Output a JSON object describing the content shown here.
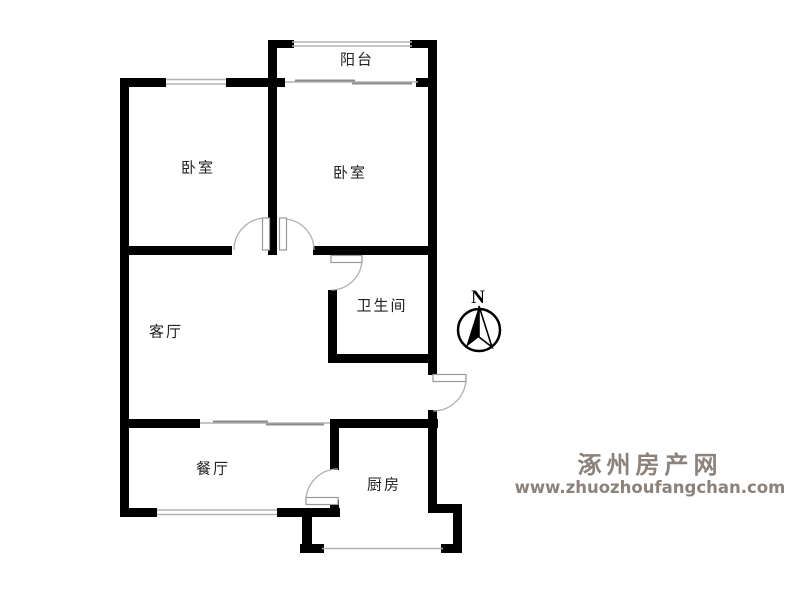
{
  "floorplan": {
    "rooms": [
      {
        "id": "balcony",
        "label": "阳台"
      },
      {
        "id": "bedroom-left",
        "label": "卧室"
      },
      {
        "id": "bedroom-right",
        "label": "卧室"
      },
      {
        "id": "living-room",
        "label": "客厅"
      },
      {
        "id": "bathroom",
        "label": "卫生间"
      },
      {
        "id": "dining-room",
        "label": "餐厅"
      },
      {
        "id": "kitchen",
        "label": "厨房"
      }
    ],
    "compass": {
      "label": "N"
    },
    "watermark": {
      "site_name": "涿州房产网",
      "site_url": "www.zhuozhoufangchan.com"
    },
    "colors": {
      "wall": "#000000",
      "window_line": "#b3b3b3",
      "sliding_mark": "#8c8c8c",
      "door_arc": "#b0b0b0",
      "door_leaf_border": "#999999",
      "label_text": "#222222",
      "watermark_text": "#8b827b"
    }
  }
}
